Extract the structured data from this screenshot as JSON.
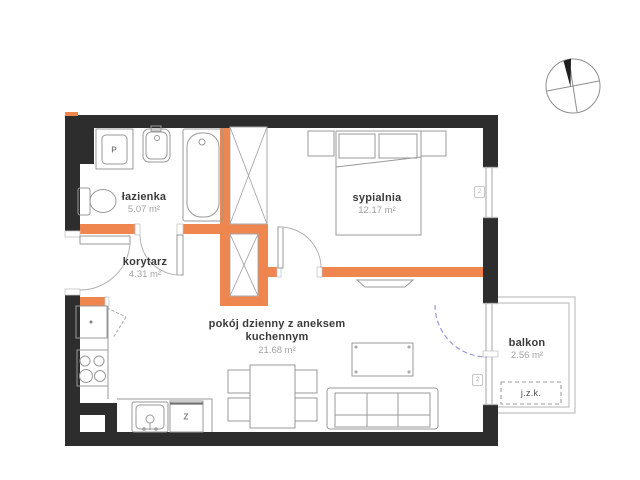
{
  "colors": {
    "wall-dark": "#2d2d2d",
    "wall-accent": "#ef8650",
    "furniture-line": "#999999",
    "room-name": "#3b3b3b",
    "room-area": "#a2a2a2",
    "balcony-arc": "#9b9bd7"
  },
  "rooms": [
    {
      "name": "łazienka",
      "area": "5.07 m²"
    },
    {
      "name": "korytarz",
      "area": "4.31 m²"
    },
    {
      "name": "sypialnia",
      "area": "12.17 m²"
    },
    {
      "name": "pokój dzienny z aneksem kuchennym",
      "area": "21.68 m²"
    },
    {
      "name": "balkon",
      "area": "2.56 m²"
    }
  ],
  "appliances": {
    "washing_machine": "P",
    "dishwasher": "Z"
  },
  "balcony": {
    "ac_unit_label": "j.z.k."
  },
  "markers": {
    "bedroom_window": "2",
    "living_window": "2"
  }
}
